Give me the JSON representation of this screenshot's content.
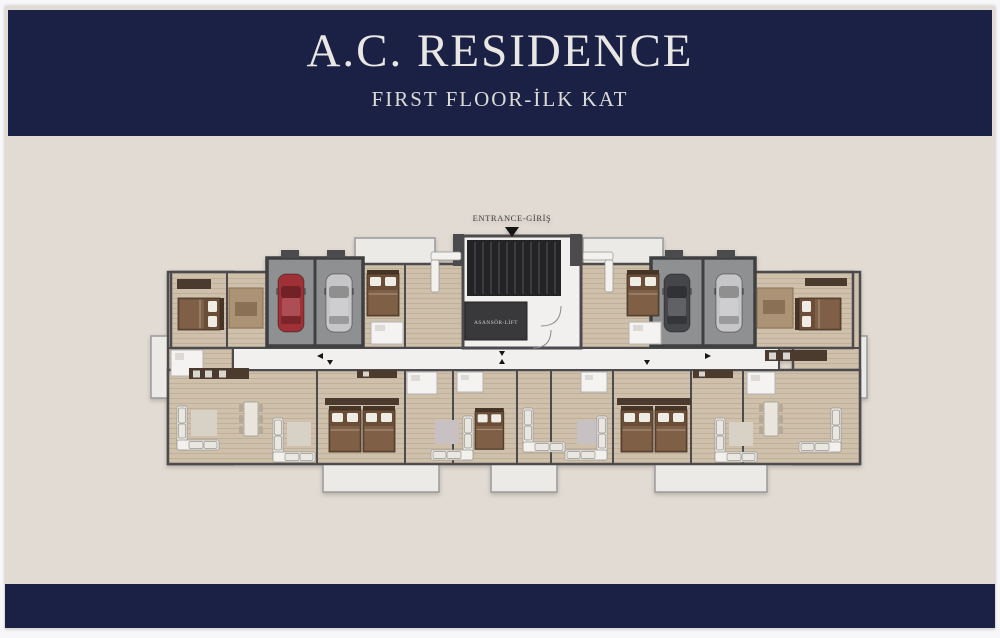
{
  "header": {
    "title": "A.C. RESIDENCE",
    "subtitle": "FIRST FLOOR-İLK KAT"
  },
  "plan": {
    "entrance_label": "ENTRANCE-GİRİŞ",
    "elevator_label": "ASANSÖR-LİFT"
  },
  "colors": {
    "band_navy": "#1b2145",
    "sheet_beige": "#e2dbd3",
    "frame_white": "#f7f6f8",
    "header_text": "#e9e7e4",
    "wall_dark": "#4b4b4d",
    "floor_tan": "#cec0ab",
    "floor_light": "#f2f0ee",
    "garage_gray": "#8f9092",
    "car_red": "#9e3036",
    "car_silver": "#c6c6c8",
    "car_dark": "#44464a",
    "bed_brown": "#6b4e38",
    "balcony": "#eceae6"
  }
}
